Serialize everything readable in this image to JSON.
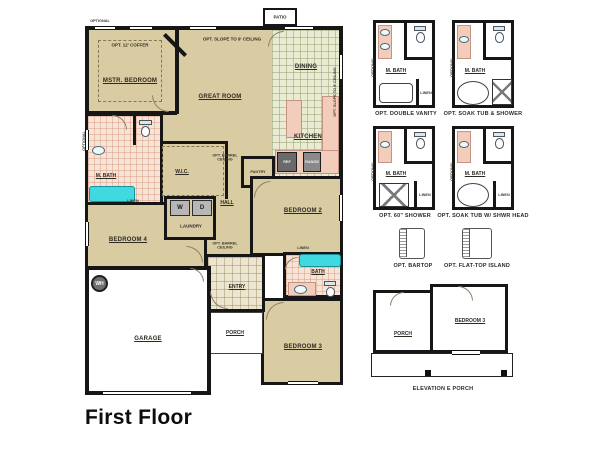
{
  "title": "First Floor",
  "colors": {
    "wall": "#161616",
    "room_fill": "#d9cca2",
    "tile_kitchen": "#e9ebd2",
    "tile_bath": "#f6e4d8",
    "counter": "#f2cdbb",
    "fixture": "#3fd9df",
    "appliance": "#6a6a6a"
  },
  "plan": {
    "rooms": {
      "mstr_bedroom": "MSTR. BEDROOM",
      "great_room": "GREAT ROOM",
      "dining": "DINING",
      "kitchen": "KITCHEN",
      "patio": "PATIO",
      "m_bath": "M. BATH",
      "wic": "W.I.C.",
      "laundry": "LAUNDRY",
      "hall": "HALL",
      "pantry": "PANTRY",
      "bedroom_2": "BEDROOM 2",
      "bedroom_3": "BEDROOM 3",
      "bedroom_4": "BEDROOM 4",
      "bath": "BATH",
      "entry": "ENTRY",
      "porch": "PORCH",
      "garage": "GARAGE"
    },
    "notes": {
      "optional": "OPTIONAL",
      "opt_coffer": "OPT. 12' COFFER",
      "opt_slope": "OPT. SLOPE TO 9' CEILING",
      "opt_barrel": "OPT. BARREL CEILING",
      "linen": "LINEN",
      "washer": "W",
      "dryer": "D",
      "water_heater": "WH",
      "ref": "REF",
      "range": "RANGE"
    }
  },
  "options": {
    "bath": [
      {
        "room": "M. BATH",
        "caption": "OPT. DOUBLE VANITY",
        "linen": "LINEN",
        "side": "OPTIONAL"
      },
      {
        "room": "M. BATH",
        "caption": "OPT. SOAK TUB & SHOWER",
        "side": "OPTIONAL"
      },
      {
        "room": "M. BATH",
        "caption": "OPT. 60\" SHOWER",
        "linen": "LINEN",
        "side": "OPTIONAL"
      },
      {
        "room": "M. BATH",
        "caption": "OPT. SOAK TUB W/ SHWR HEAD",
        "linen": "LINEN",
        "side": "OPTIONAL"
      }
    ],
    "kitchen": [
      {
        "caption": "OPT. BARTOP"
      },
      {
        "caption": "OPT. FLAT-TOP ISLAND"
      }
    ],
    "elevation": {
      "caption": "ELEVATION E PORCH",
      "porch": "PORCH",
      "bedroom": "BEDROOM 3"
    }
  }
}
